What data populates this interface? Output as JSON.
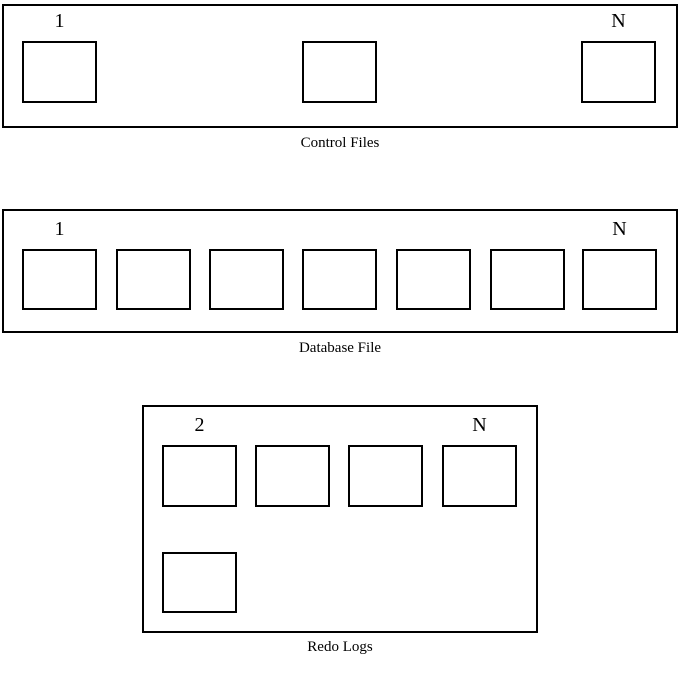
{
  "diagram_title": "Database files diagram",
  "colors": {
    "background": "#ffffff",
    "line": "#000000",
    "text": "#000000"
  },
  "control_files": {
    "caption": "Control Files",
    "first_label": "1",
    "last_label": "N",
    "box_count": 3
  },
  "database_file": {
    "caption": "Database File",
    "first_label": "1",
    "last_label": "N",
    "box_count": 7
  },
  "redo_logs": {
    "caption": "Redo Logs",
    "first_label": "2",
    "last_label": "N",
    "box_count_top_row": 4,
    "box_count_bottom_row": 1
  }
}
